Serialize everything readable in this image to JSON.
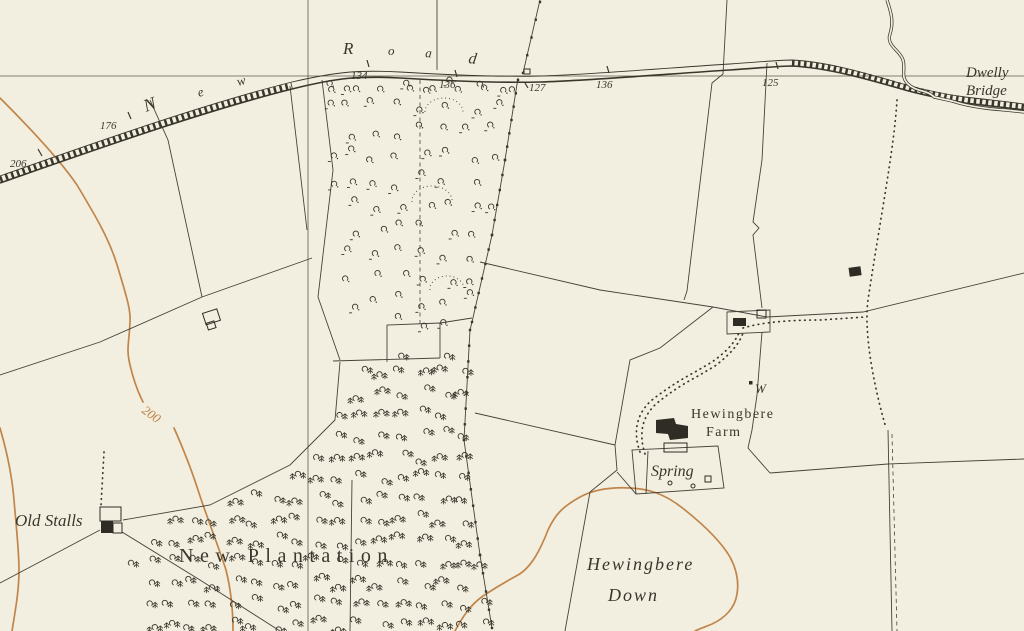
{
  "map": {
    "type": "topographic-map",
    "background_color": "#f2efe0",
    "ink_color": "#39372c",
    "contour_color": "#c1854a",
    "labels": {
      "road_name": "New Road",
      "road_letters": [
        {
          "ch": "N"
        },
        {
          "ch": "e"
        },
        {
          "ch": "w"
        },
        {
          "ch": "R"
        },
        {
          "ch": "o"
        },
        {
          "ch": "a"
        },
        {
          "ch": "d"
        }
      ],
      "bridge": {
        "line1": "Dwelly",
        "line2": "Bridge"
      },
      "farm": {
        "line1": "Hewingbere",
        "line2": "Farm"
      },
      "down": {
        "line1": "Hewingbere",
        "line2": "Down"
      },
      "plantation": "New Plantation",
      "old_stalls": "Old Stalls",
      "spring": "Spring",
      "well": "W",
      "contour_value": "200",
      "spot_heights": [
        {
          "value": "206"
        },
        {
          "value": "176"
        },
        {
          "value": "134"
        },
        {
          "value": "136"
        },
        {
          "value": "127"
        },
        {
          "value": "136"
        },
        {
          "value": "125"
        }
      ]
    }
  }
}
